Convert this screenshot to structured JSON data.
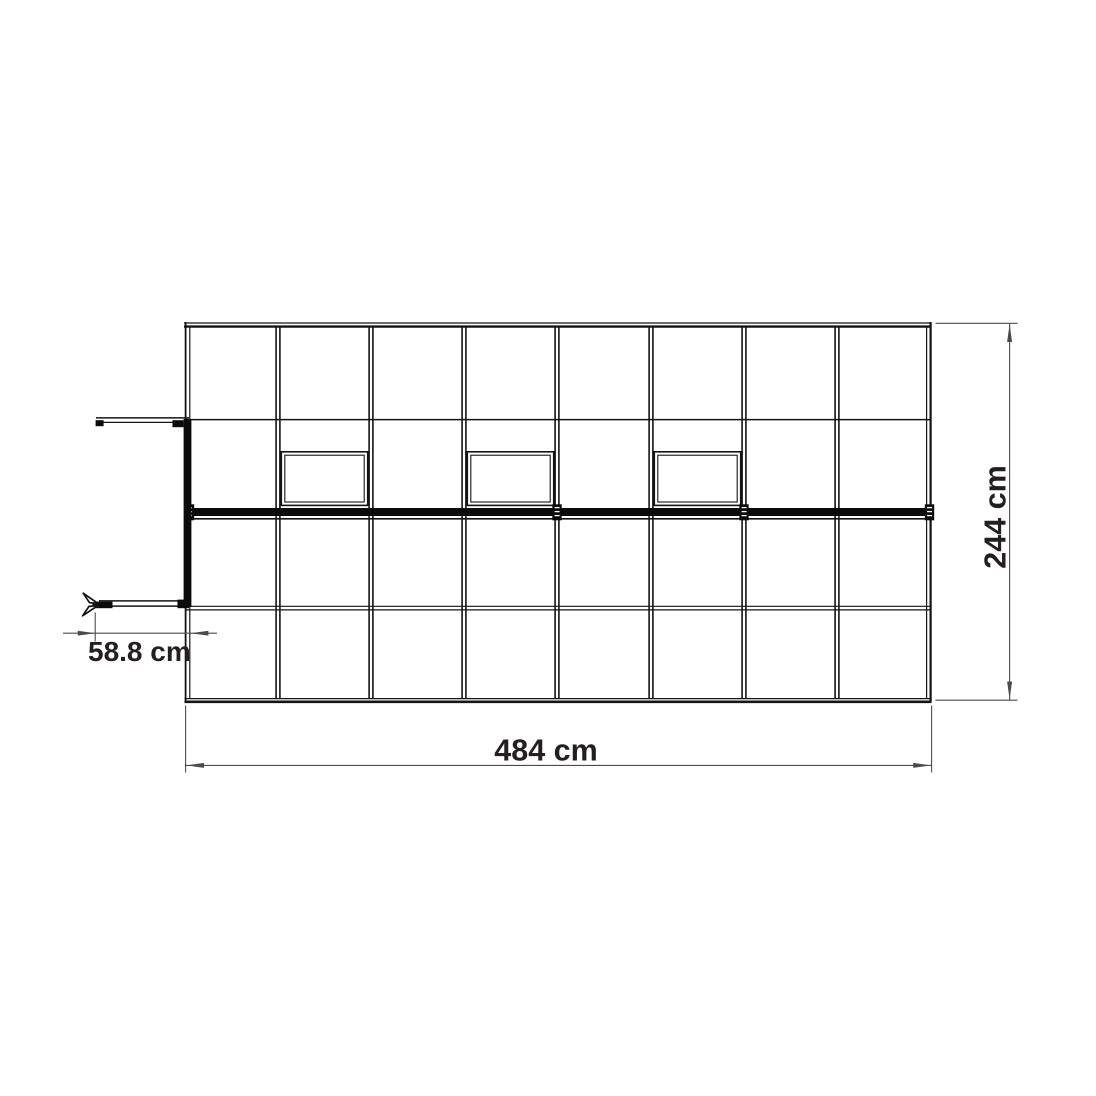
{
  "page": {
    "background": "#ffffff"
  },
  "diagram": {
    "type": "greenhouse-floor-plan-top-view",
    "labels": {
      "width": "484 cm",
      "depth": "244 cm",
      "door_offset": "58.8 cm"
    },
    "structure": {
      "grid_columns": 8,
      "roof_windows": 3,
      "ridge_connectors": 4
    },
    "colors": {
      "frame_line": "#141414",
      "ridge_fill": "#0b0b0b",
      "dimension_line": "#4a4b4d",
      "text": "#231f20",
      "background": "#ffffff"
    }
  }
}
